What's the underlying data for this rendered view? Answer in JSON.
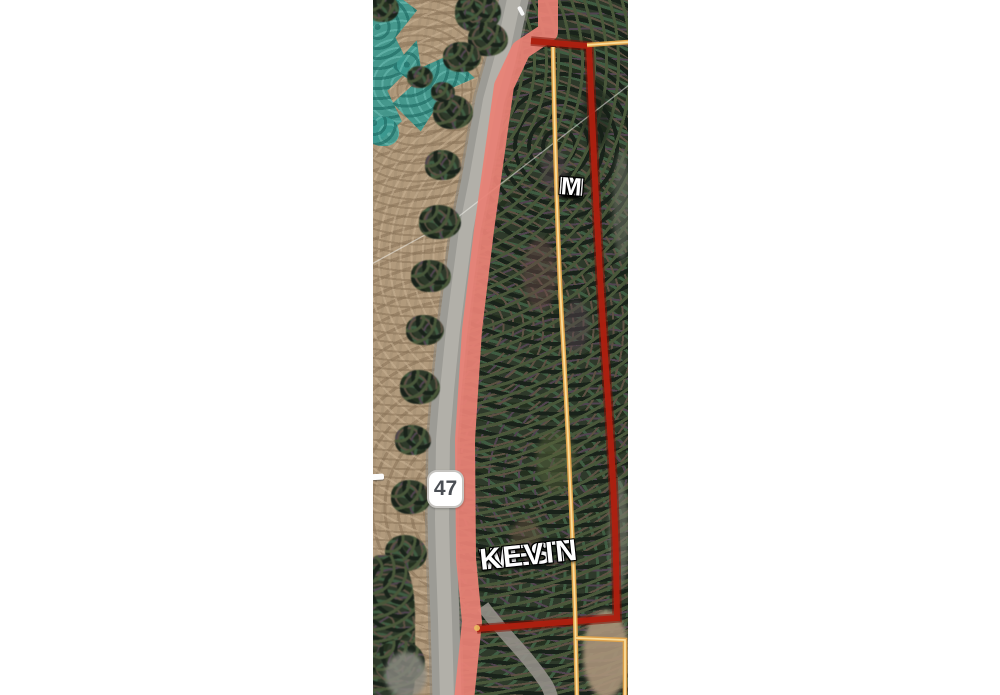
{
  "route_shield": {
    "number": "47"
  },
  "parcel_labels": {
    "vertical_text": "WEST KEVIN M",
    "vertical_rows": [
      "W",
      "E",
      "S",
      "T",
      "K",
      "E",
      "V",
      "IN",
      "M"
    ],
    "horizontal_text": "WEST KEVIN",
    "horizontal_line1": "WEST",
    "horizontal_line2": "KEVIN"
  },
  "colors": {
    "road_highlight": "#e98175",
    "parcel_highlight": "#ad2010",
    "parcel_highlight_edge": "#7d1005",
    "parcel_line": "#dfa24b",
    "parcel_line_core": "#f8dc9a",
    "wetland_overlay": "#3b988f",
    "road_gray": "#9c9b95",
    "field_tan": "#b19a7c",
    "forest_dark": "#2e392a",
    "label_text": "#ffffff",
    "shield_text": "#4a4e54"
  }
}
